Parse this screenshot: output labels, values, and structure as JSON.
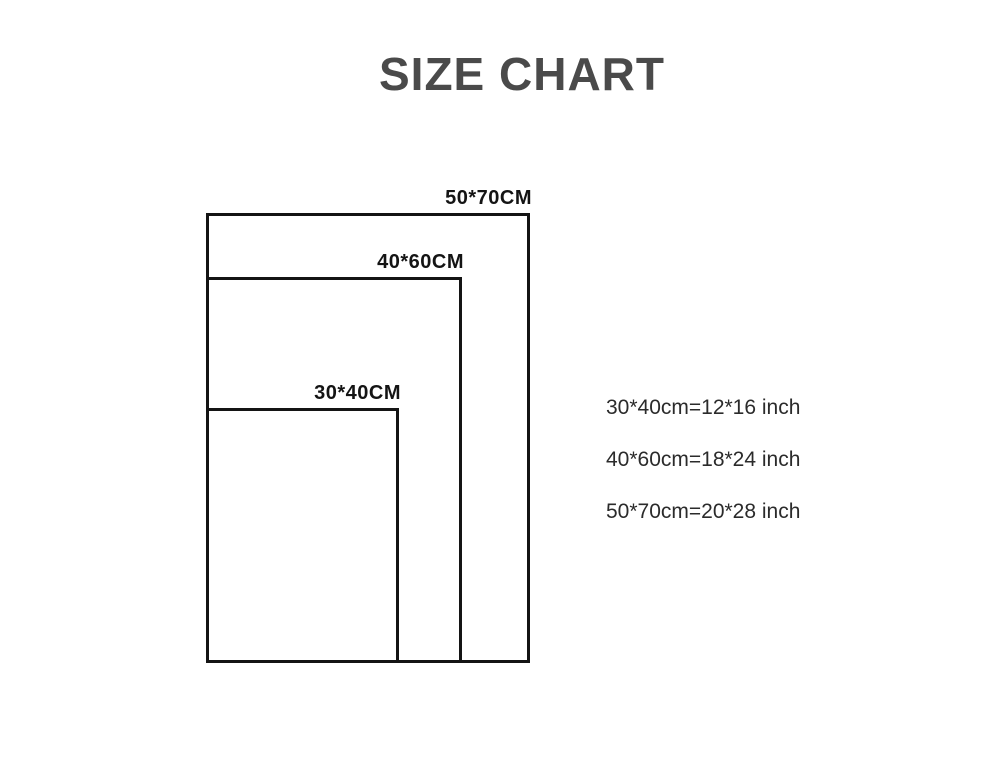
{
  "title": "SIZE CHART",
  "diagram": {
    "rectangles": [
      {
        "name": "50x70",
        "label": "50*70CM"
      },
      {
        "name": "40x60",
        "label": "40*60CM"
      },
      {
        "name": "30x40",
        "label": "30*40CM"
      }
    ]
  },
  "conversions": {
    "line_30x40": "30*40cm=12*16 inch",
    "line_40x60": "40*60cm=18*24 inch",
    "line_50x70": "50*70cm=20*28 inch"
  },
  "colors": {
    "title": "#4a4a4a",
    "line": "#141414",
    "body_text": "#2b2b2b",
    "background": "#ffffff"
  }
}
